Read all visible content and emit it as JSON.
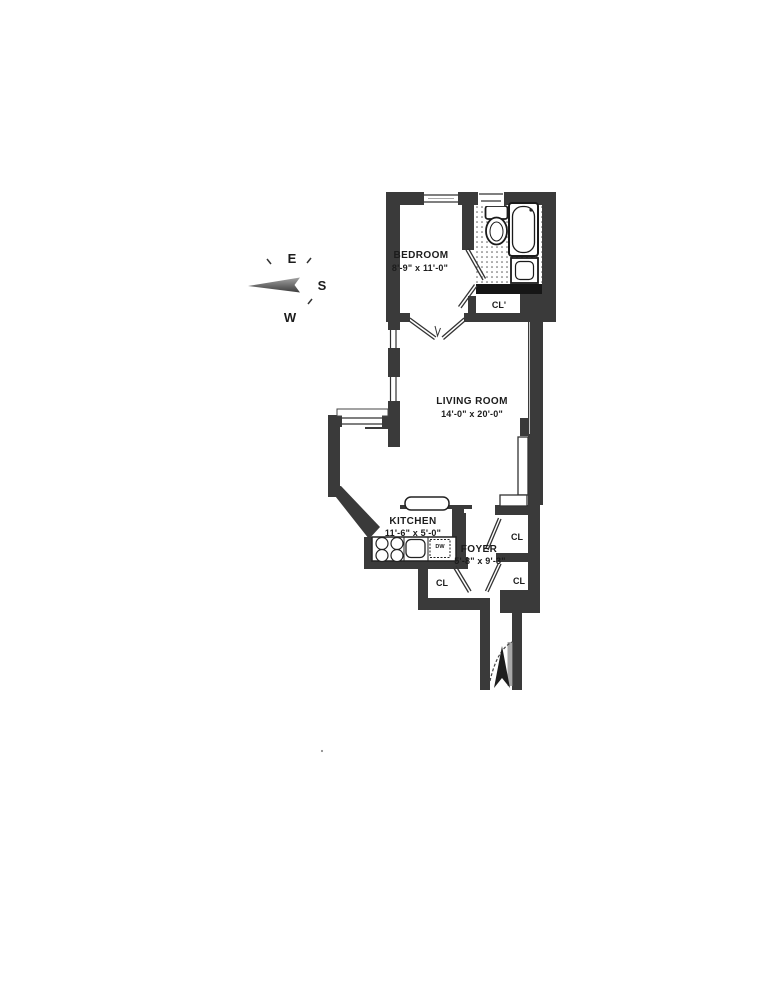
{
  "document": {
    "type": "floor-plan-scan",
    "background": "#ffffff"
  },
  "compass": {
    "east_label": "E",
    "south_label": "S",
    "west_label": "W"
  },
  "rooms": {
    "bedroom": {
      "name": "BEDROOM",
      "dimensions": "8'-9\" x 11'-0\""
    },
    "living_room": {
      "name": "LIVING ROOM",
      "dimensions": "14'-0\" x 20'-0\""
    },
    "kitchen": {
      "name": "KITCHEN",
      "dimensions": "11'-6\" x 5'-0\""
    },
    "foyer": {
      "name": "FOYER",
      "dimensions": "5'-8\" x 9'-3\""
    }
  },
  "closets": {
    "bedroom_closet": "CL'",
    "foyer_upper_right": "CL",
    "foyer_lower_right": "CL",
    "foyer_lower_left": "CL"
  },
  "labels": {
    "dishwasher": "DW"
  },
  "colors": {
    "wall": "#3a3a3a",
    "wall_dark": "#161616",
    "paper": "#ffffff",
    "line": "#2e2e2e"
  }
}
